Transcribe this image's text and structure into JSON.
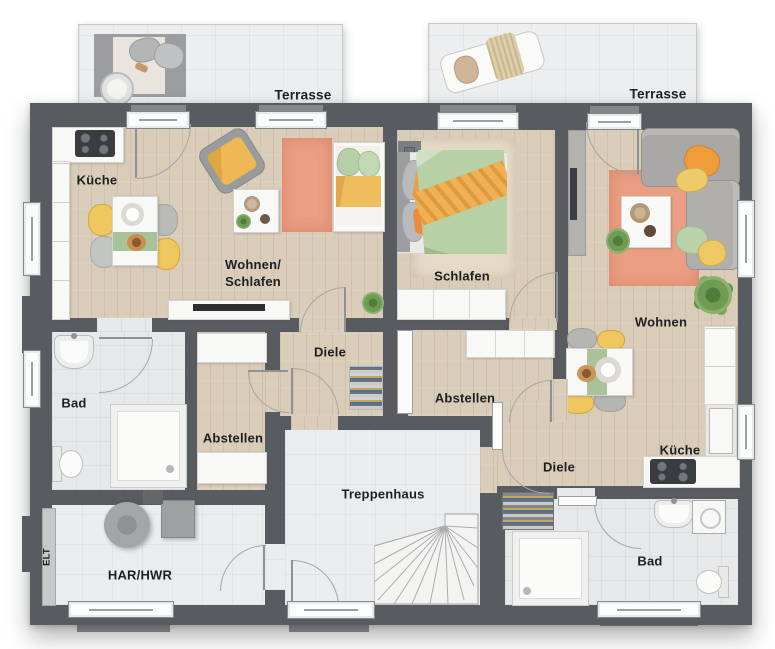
{
  "plan": {
    "type": "floor-plan-top-view",
    "labels": {
      "terrasse_left": "Terrasse",
      "terrasse_right": "Terrasse",
      "kueche_left": "Küche",
      "wohnen_schlafen_line1": "Wohnen/",
      "wohnen_schlafen_line2": "Schlafen",
      "schlafen": "Schlafen",
      "wohnen": "Wohnen",
      "diele_left": "Diele",
      "diele_right": "Diele",
      "bad_left": "Bad",
      "bad_right": "Bad",
      "abstellen_left": "Abstellen",
      "abstellen_middle": "Abstellen",
      "kueche_right": "Küche",
      "treppenhaus": "Treppenhaus",
      "har_hwr": "HAR/HWR",
      "elt": "ELT"
    },
    "colors": {
      "wall": "#585b5f",
      "wood_floor": "#d9ccb9",
      "bath_tile": "#e6e8e9",
      "stair_tile": "#ebeced",
      "terrace_tile": "#edeeef",
      "rug_salmon": "#eb9e82",
      "duvet_green": "#b7d0a5",
      "accent_orange": "#efa044",
      "accent_yellow": "#eec963",
      "sofa_gray": "#a9a8a6",
      "furniture_white": "#f8f8f7",
      "label_text": "#1d1f22"
    },
    "rooms": [
      {
        "id": "terrace-left",
        "label": "Terrasse"
      },
      {
        "id": "terrace-right",
        "label": "Terrasse"
      },
      {
        "id": "kitchen-left",
        "label": "Küche"
      },
      {
        "id": "living-sleeping-left",
        "label": "Wohnen/Schlafen"
      },
      {
        "id": "bedroom-middle",
        "label": "Schlafen"
      },
      {
        "id": "living-right",
        "label": "Wohnen"
      },
      {
        "id": "hall-left",
        "label": "Diele"
      },
      {
        "id": "bath-left",
        "label": "Bad"
      },
      {
        "id": "storage-left",
        "label": "Abstellen"
      },
      {
        "id": "storage-middle",
        "label": "Abstellen"
      },
      {
        "id": "hall-right",
        "label": "Diele"
      },
      {
        "id": "kitchen-right",
        "label": "Küche"
      },
      {
        "id": "stairwell",
        "label": "Treppenhaus"
      },
      {
        "id": "utility",
        "label": "HAR/HWR"
      },
      {
        "id": "bath-right",
        "label": "Bad"
      },
      {
        "id": "electrical",
        "label": "ELT"
      }
    ]
  }
}
